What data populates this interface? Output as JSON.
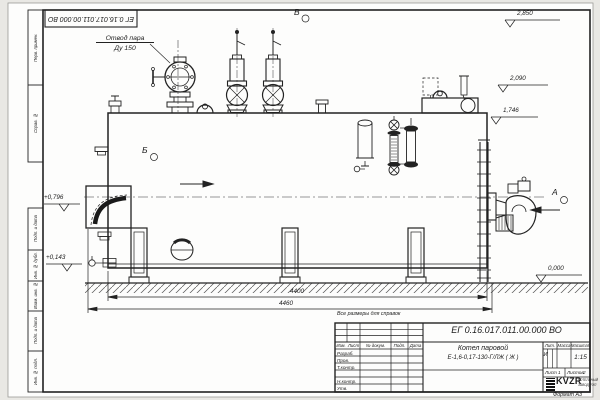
{
  "sheet": {
    "top_stamp": "ЕГ 0.16.017.011.00.000  ВО",
    "format_note": "Формат А3",
    "reference_note": "Все размеры для справок"
  },
  "margin_columns": {
    "perv_primen": "Перв. примен.",
    "sprav_no": "Справ. №",
    "podp_data_1": "Подп. и дата",
    "inv_dubl": "Инв. № дубл.",
    "vzam_inv": "Взам. инв. №",
    "podp_data_2": "Подп. и дата",
    "inv_podl": "Инв. № подл."
  },
  "drawing": {
    "callout_steam_line1": "Отвод пара",
    "callout_steam_line2": "Ду 150",
    "view_v": "В",
    "view_b": "Б",
    "view_a": "А",
    "elev_2850": "2,850",
    "elev_2090": "2,090",
    "elev_1746": "1,746",
    "elev_0000": "0,000",
    "elev_0796": "+0,796",
    "elev_0143": "+0,143",
    "dim_4400": "4400",
    "dim_4460": "4460"
  },
  "title_block": {
    "doc_number": "ЕГ 0.16.017.011.00.000  ВО",
    "name_line1": "Котел паровой",
    "name_line2": "Е-1,6-0,17-130-Г/ЛЖ ( Ж )",
    "col_izm": "Изм.",
    "col_list": "Лист",
    "col_doc": "№ докум.",
    "col_podp": "Подп.",
    "col_data": "Дата",
    "row_razrab": "Разраб.",
    "row_prov": "Пров.",
    "row_tkontr": "Т.контр.",
    "row_nkontr": "Н.контр.",
    "row_utv": "Утв.",
    "lit_label": "Лит.",
    "mass_label": "Масса",
    "scale_label": "Масштаб",
    "lit_value": "И",
    "scale_value": "1:15",
    "sheet_label": "Лист",
    "sheet_value": "1",
    "sheets_label": "Листов",
    "sheets_value": "2",
    "logo_text": "KVZR",
    "logo_sub1": "КОТЕЛЬНЫЙ",
    "logo_sub2": "ЗАВОД РЭП"
  }
}
